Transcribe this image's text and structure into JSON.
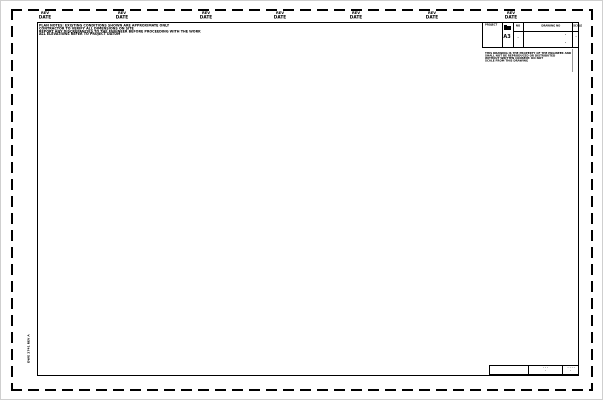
{
  "colors": {
    "line": "#000000",
    "page_bg": "#ffffff",
    "fold_line": "#9a9a9a",
    "screenshot_border": "#cfcfcf"
  },
  "top_labels": [
    {
      "top": "REV",
      "bottom": "DATE"
    },
    {
      "top": "REV",
      "bottom": "DATE"
    },
    {
      "top": "REV",
      "bottom": "DATE"
    },
    {
      "top": "REV",
      "bottom": "DATE"
    },
    {
      "top": "REV",
      "bottom": "DATE"
    },
    {
      "top": "REV",
      "bottom": "DATE"
    },
    {
      "top": "REV",
      "bottom": "DATE"
    }
  ],
  "note_left": {
    "lines": [
      "PLAN NOTES: EXISTING CONDITIONS SHOWN ARE APPROXIMATE ONLY",
      "CONTRACTOR TO VERIFY ALL DIMENSIONS ON SITE",
      "REPORT ANY DISCREPANCIES TO THE ENGINEER BEFORE PROCEEDING WITH THE WORK",
      "ALL ELEVATIONS REFER TO PROJECT DATUM"
    ]
  },
  "title_block": {
    "col1_label": "PROJECT",
    "size_code": "A3",
    "col3_label": "NO",
    "col3_value": "·",
    "col4_label": "DRAWING NO",
    "col4_value_top": "·",
    "col4_value_bottom": "·",
    "col5_label": "SCALE",
    "col5_value": "·"
  },
  "note_right": {
    "lines": [
      "THIS DRAWING IS THE PROPERTY OF THE ENGINEER AND",
      "SHALL NOT BE REPRODUCED OR DISTRIBUTED",
      "WITHOUT WRITTEN CONSENT. DO NOT",
      "SCALE FROM THIS DRAWING"
    ]
  },
  "bottom_strip": {
    "cell2_row1": "· · ·",
    "cell2_row2": "·",
    "cell3_row1": "· · · ·",
    "cell3_row2": "·"
  },
  "side_label": "DWG 2741 REV A"
}
